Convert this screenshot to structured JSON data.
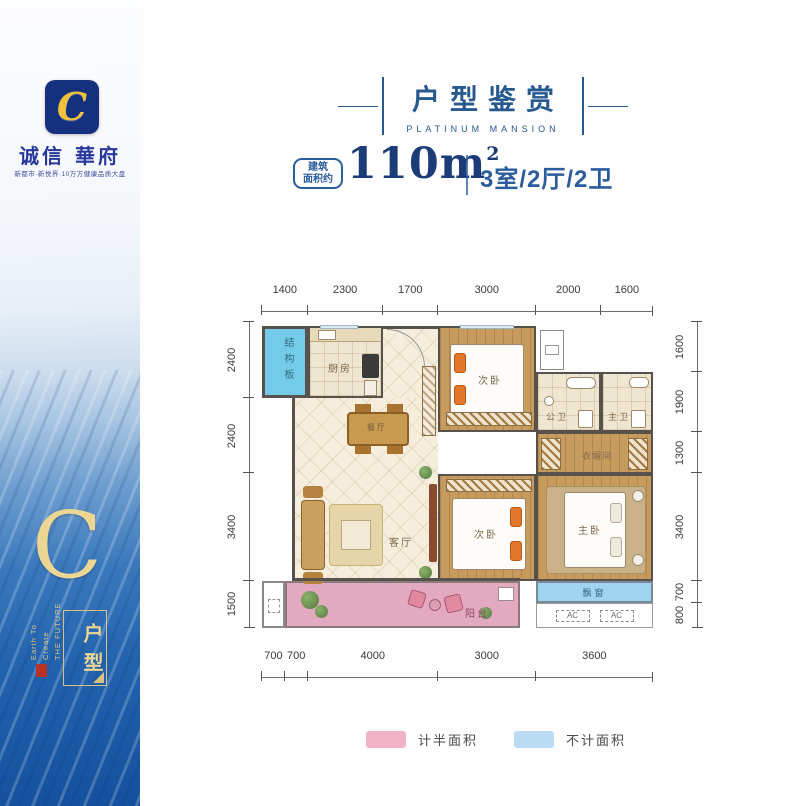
{
  "sidebar": {
    "logo_letter": "C",
    "brand": "诚信 華府",
    "tagline": "新都市·新悦界·10万方健康品质大盘",
    "big_letter": "C",
    "en_line1": "Earth To Create",
    "en_line2": "THE FUTURE",
    "unit_label": "户型",
    "colors": {
      "deep_blue": "#14509d",
      "gold": "#ecd693"
    }
  },
  "header": {
    "title": "户型鉴赏",
    "subtitle": "PLATINUM MANSION",
    "accent_color": "#27598f"
  },
  "summary": {
    "badge_line1": "建筑",
    "badge_line2": "面积约",
    "area_value": "110",
    "area_unit": "m",
    "area_sup": "2",
    "spec": "3室/2厅/2卫"
  },
  "plan": {
    "rooms": {
      "structure_slab": "结构板",
      "kitchen": "厨房",
      "bedroom_top": "次卧",
      "bath_guest": "公卫",
      "bath_master": "主卫",
      "dining": "餐厅",
      "living": "客厅",
      "bedroom_mid": "次卧",
      "master": "主卧",
      "closet": "衣帽间",
      "balcony": "阳台",
      "bay_window": "飘窗",
      "ac": "AC"
    },
    "dims": {
      "top": [
        1400,
        2300,
        1700,
        3000,
        2000,
        1600
      ],
      "bottom": [
        700,
        700,
        4000,
        3000,
        3600
      ],
      "left": [
        2400,
        2400,
        3400,
        1500
      ],
      "right": [
        1600,
        1900,
        1300,
        3400,
        700,
        800
      ]
    },
    "colors": {
      "half_area": "#e2a9c1",
      "excluded": "#9ed4ef",
      "slab": "#74cbe9"
    }
  },
  "legend": {
    "items": [
      {
        "label": "计半面积",
        "color": "#f2b2c5"
      },
      {
        "label": "不计面积",
        "color": "#b9dcf2"
      }
    ]
  }
}
